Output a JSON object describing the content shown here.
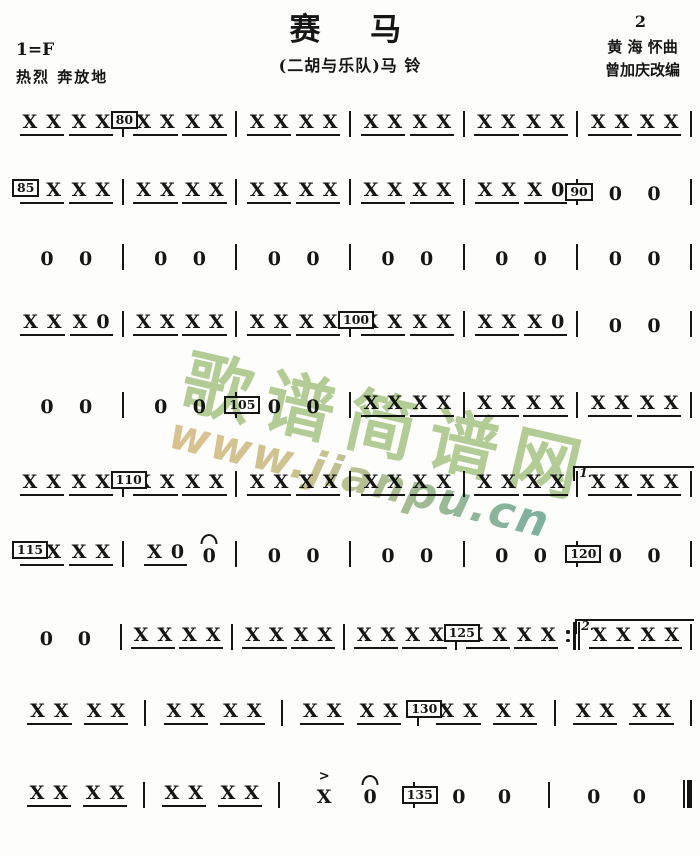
{
  "header": {
    "title": "赛　马",
    "subtitle": "(二胡与乐队)马 铃",
    "page_number": "2",
    "composer": "黄 海 怀曲",
    "arranger": "曾加庆改编",
    "key_signature": "1=F",
    "tempo_text": "热烈 奔放地"
  },
  "watermark": {
    "site_name": "歌谱简谱网",
    "site_url": "www.jianpu.cn",
    "chars_color": "#a8c586",
    "url_color_start": "#d7b97f",
    "url_color_end": "#64a493"
  },
  "score": {
    "note_symbol": "X",
    "rest_symbol": "0",
    "accent_symbol": ">",
    "lines": [
      {
        "top": 99,
        "measures": [
          {
            "beats": [
              "XX",
              "XX"
            ]
          },
          {
            "marker": "80",
            "beats": [
              "XX",
              "XX"
            ]
          },
          {
            "beats": [
              "XX",
              "XX"
            ]
          },
          {
            "beats": [
              "XX",
              "XX"
            ]
          },
          {
            "beats": [
              "XX",
              "XX"
            ]
          },
          {
            "beats": [
              "XX",
              "XX"
            ]
          }
        ]
      },
      {
        "top": 167,
        "measures": [
          {
            "marker": "85",
            "marker_first": true,
            "beats": [
              "XX",
              "XX"
            ]
          },
          {
            "beats": [
              "XX",
              "XX"
            ]
          },
          {
            "beats": [
              "XX",
              "XX"
            ]
          },
          {
            "beats": [
              "XX",
              "XX"
            ]
          },
          {
            "beats": [
              "XX",
              "X0"
            ]
          },
          {
            "marker": "90",
            "beats": [
              "0",
              "0"
            ]
          }
        ]
      },
      {
        "top": 232,
        "measures": [
          {
            "beats": [
              "0",
              "0"
            ]
          },
          {
            "beats": [
              "0",
              "0"
            ]
          },
          {
            "beats": [
              "0",
              "0"
            ]
          },
          {
            "beats": [
              "0",
              "0"
            ]
          },
          {
            "beats": [
              "0",
              "0"
            ]
          },
          {
            "beats": [
              "0",
              "0"
            ]
          }
        ]
      },
      {
        "top": 299,
        "measures": [
          {
            "beats": [
              "XX",
              "X0"
            ]
          },
          {
            "beats": [
              "XX",
              "XX"
            ]
          },
          {
            "beats": [
              "XX",
              "XX"
            ]
          },
          {
            "marker": "100",
            "beats": [
              "XX",
              "XX"
            ]
          },
          {
            "beats": [
              "XX",
              "X0"
            ]
          },
          {
            "beats": [
              "0",
              "0"
            ]
          }
        ]
      },
      {
        "top": 380,
        "measures": [
          {
            "beats": [
              "0",
              "0"
            ]
          },
          {
            "beats": [
              "0",
              "0"
            ]
          },
          {
            "marker": "105",
            "beats": [
              "0",
              "0"
            ]
          },
          {
            "beats": [
              "XX",
              "XX"
            ]
          },
          {
            "beats": [
              "XX",
              "XX"
            ]
          },
          {
            "beats": [
              "XX",
              "XX"
            ]
          }
        ]
      },
      {
        "top": 459,
        "measures": [
          {
            "beats": [
              "XX",
              "XX"
            ]
          },
          {
            "marker": "110",
            "beats": [
              "XX",
              "XX"
            ]
          },
          {
            "beats": [
              "XX",
              "XX"
            ]
          },
          {
            "beats": [
              "XX",
              "XX"
            ]
          },
          {
            "beats": [
              "XX",
              "XX"
            ]
          },
          {
            "volta": "1.",
            "beats": [
              "XX",
              "XX"
            ]
          }
        ]
      },
      {
        "top": 529,
        "measures": [
          {
            "marker": "115",
            "marker_first": true,
            "beats": [
              "XX",
              "XX"
            ]
          },
          {
            "beats": [
              "X0",
              "0f"
            ]
          },
          {
            "beats": [
              "0",
              "0"
            ]
          },
          {
            "beats": [
              "0",
              "0"
            ]
          },
          {
            "beats": [
              "0",
              "0"
            ]
          },
          {
            "marker": "120",
            "beats": [
              "0",
              "0"
            ]
          }
        ]
      },
      {
        "top": 612,
        "measures": [
          {
            "beats": [
              "0",
              "0"
            ]
          },
          {
            "beats": [
              "XX",
              "XX"
            ]
          },
          {
            "beats": [
              "XX",
              "XX"
            ]
          },
          {
            "beats": [
              "XX",
              "XX"
            ]
          },
          {
            "marker": "125",
            "endbar": "repeat",
            "beats": [
              "XX",
              "XX"
            ]
          },
          {
            "volta": "2.",
            "beats": [
              "XX",
              "XX"
            ]
          }
        ]
      },
      {
        "top": 688,
        "measures": [
          {
            "beats": [
              "XX",
              "XX"
            ]
          },
          {
            "beats": [
              "XX",
              "XX"
            ]
          },
          {
            "beats": [
              "XX",
              "XX"
            ]
          },
          {
            "marker": "130",
            "beats": [
              "XX",
              "XX"
            ]
          },
          {
            "beats": [
              "XX",
              "XX"
            ]
          }
        ]
      },
      {
        "top": 770,
        "measures": [
          {
            "beats": [
              "XX",
              "XX"
            ]
          },
          {
            "beats": [
              "XX",
              "XX"
            ]
          },
          {
            "beats": [
              "Xa",
              "0f"
            ]
          },
          {
            "marker": "135",
            "beats": [
              "0",
              "0"
            ]
          },
          {
            "endbar": "final",
            "beats": [
              "0",
              "0"
            ]
          }
        ]
      }
    ]
  }
}
